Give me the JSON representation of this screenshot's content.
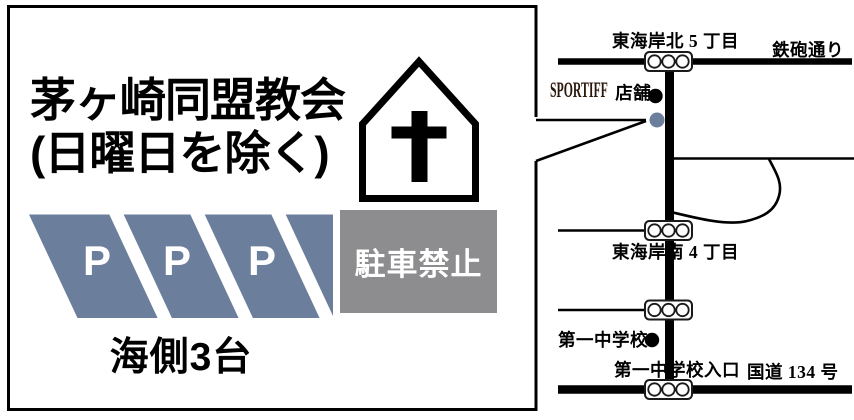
{
  "panel": {
    "church_name": "茅ヶ崎同盟教会",
    "schedule_note": "(日曜日を除く)",
    "parking_letters": [
      "P",
      "P",
      "P"
    ],
    "no_parking_label": "駐車禁止",
    "capacity_note": "海側3台"
  },
  "map": {
    "north_intersection_label": "東海岸北 5 丁目",
    "teppo_street_label": "鉄砲通り",
    "sportiff_store_name": "SPORTIFF",
    "sportiff_store_suffix": "店舗",
    "south_intersection_label": "東海岸南 4 丁目",
    "school_label": "第一中学校",
    "school_entrance_label": "第一中学校入口",
    "route_134_label": "国道 134 号"
  },
  "colors": {
    "parking_blue": "#6b7e9b",
    "no_parking_gray": "#8d8d8f",
    "church_marker_blue": "#6b7e9b",
    "ink": "#000000"
  },
  "icons": {
    "church": "church-icon",
    "traffic_light": "traffic-light-icon",
    "poi_dot": "location-dot"
  }
}
